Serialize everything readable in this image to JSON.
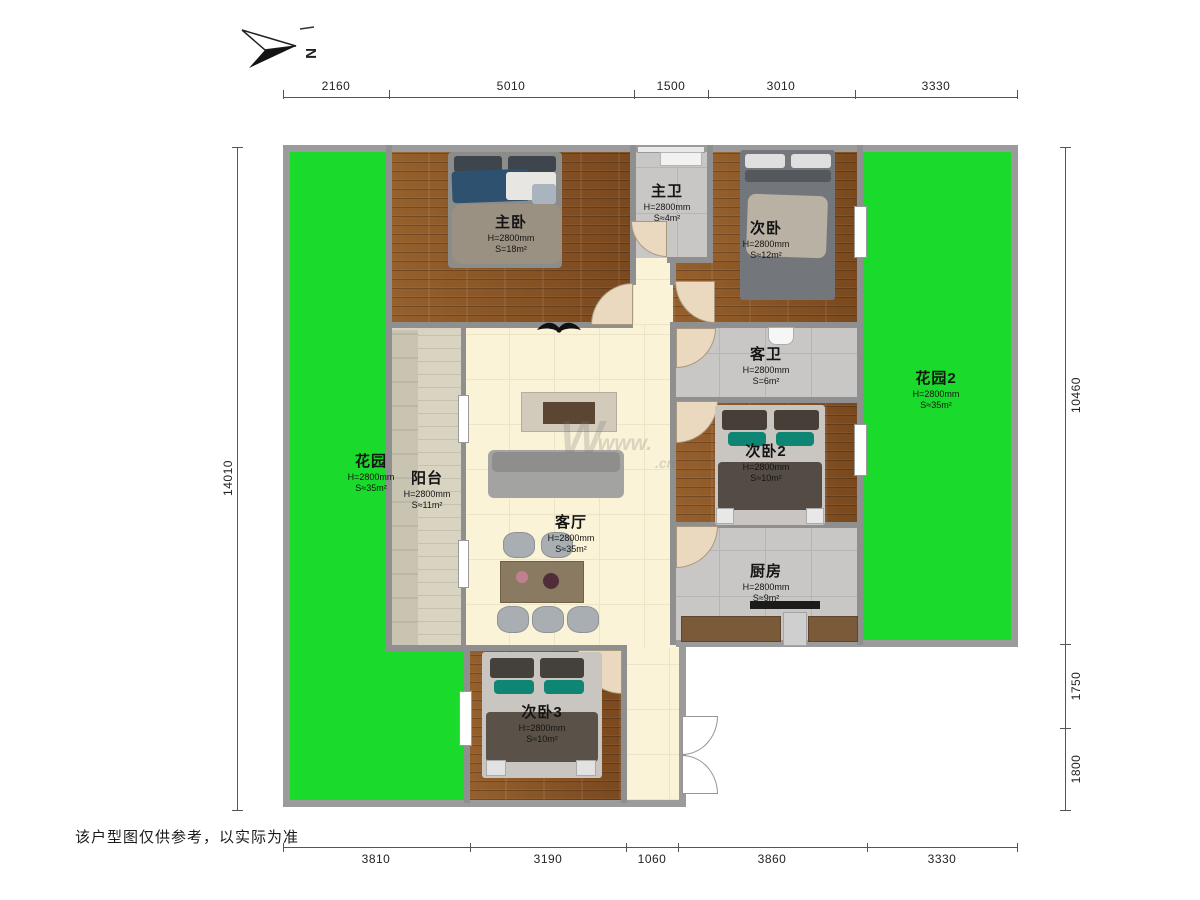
{
  "compass": {
    "label": "N"
  },
  "disclaimer": "该户型图仅供参考，以实际为准",
  "watermark": {
    "logo": "W",
    "www": "www.",
    "cn": ".cn"
  },
  "dims": {
    "top": [
      "2160",
      "5010",
      "1500",
      "3010",
      "3330"
    ],
    "bottom": [
      "3810",
      "3190",
      "1060",
      "3860",
      "3330"
    ],
    "left": [
      "14010"
    ],
    "right": [
      "10460",
      "1750",
      "1800"
    ]
  },
  "rooms": [
    {
      "name": "主卧",
      "h": "H=2800mm",
      "s": "S=18m²"
    },
    {
      "name": "主卫",
      "h": "H=2800mm",
      "s": "S≈4m²"
    },
    {
      "name": "次卧",
      "h": "H=2800mm",
      "s": "S≈12m²"
    },
    {
      "name": "客卫",
      "h": "H=2800mm",
      "s": "S=6m²"
    },
    {
      "name": "次卧2",
      "h": "H=2800mm",
      "s": "S≈10m²"
    },
    {
      "name": "厨房",
      "h": "H=2800mm",
      "s": "S≈9m²"
    },
    {
      "name": "客厅",
      "h": "H=2800mm",
      "s": "S≈35m²"
    },
    {
      "name": "阳台",
      "h": "H=2800mm",
      "s": "S≈11m²"
    },
    {
      "name": "花园",
      "h": "H=2800mm",
      "s": "S≈35m²"
    },
    {
      "name": "花园2",
      "h": "H=2800mm",
      "s": "S≈35m²"
    },
    {
      "name": "次卧3",
      "h": "H=2800mm",
      "s": "S≈10m²"
    }
  ],
  "colors": {
    "garden": "#1adb2b",
    "wood": "#8a5426",
    "tile": "#c9c7c5",
    "cream": "#faf3d8",
    "wall": "#8f8f8f",
    "accent_blue": "#2e5170",
    "accent_teal": "#0f8573"
  }
}
